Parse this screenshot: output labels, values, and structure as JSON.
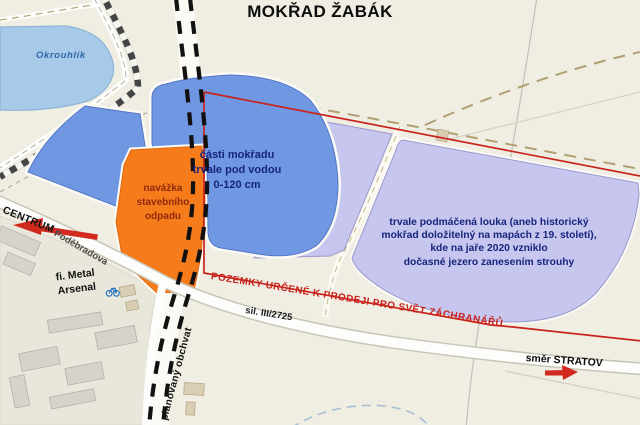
{
  "title": "MOKŘAD ŽABÁK",
  "lake": {
    "name": "Okrouhlík"
  },
  "regions": {
    "flooded_wetland": {
      "lines": [
        "části mokřadu",
        "trvale pod vodou",
        "0-120 cm"
      ]
    },
    "landfill": {
      "lines": [
        "navážka",
        "stavebního",
        "odpadu"
      ]
    },
    "wet_meadow": {
      "lines": [
        "trvale podmáčená louka (aneb historický",
        "mokřad doložitelný na mapách z 19. století),",
        "kde na jaře 2020 vzniklo",
        "dočasné jezero zanesením strouhy"
      ]
    }
  },
  "sale_boundary": {
    "label": "POZEMKY URČENÉ K PRODEJI PRO SVĚT ZÁCHRANÁŘŮ"
  },
  "roads": {
    "centrum": "CENTRUM",
    "podebradova": "Poděbradova",
    "silnice": "sil. III/2725",
    "stratov": "směr STRATOV",
    "obchvat": "plánovaný obchvat"
  },
  "places": {
    "factory": {
      "lines": [
        "fi. Metal",
        "Arsenal"
      ]
    }
  },
  "colors": {
    "lake_blue": "#a7cae8",
    "wetland_blue": "#6f97e2",
    "meadow_lavender": "#c7c6ee",
    "landfill_orange": "#f67c1b",
    "boundary_red": "#c8231c"
  }
}
